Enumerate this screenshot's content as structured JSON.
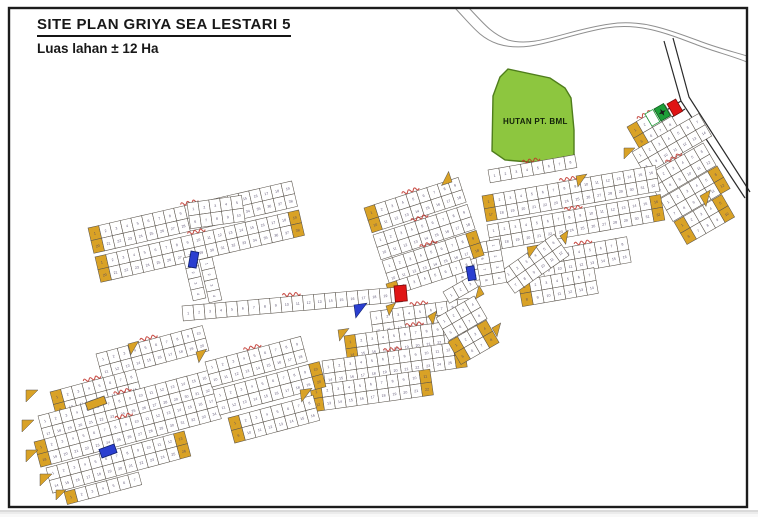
{
  "title": {
    "text": "SITE PLAN GRIYA SEA LESTARI 5",
    "subtitle": "Luas lahan  ± 12 Ha"
  },
  "forest": {
    "label": "HUTAN PT. BML",
    "fill": "#8DC63F",
    "stroke": "#4f7d1c",
    "points": "508,69 550,78 565,88 571,98 574,130 574,160 540,163 505,160 492,151 493,96 500,77"
  },
  "colors": {
    "lot_fill": "#ffffff",
    "lot_stroke": "#5a544c",
    "lot_yellow": "#D9A226",
    "label_red": "#c03028",
    "marker_blue": "#2b3fd0",
    "marker_red": "#e01414",
    "flag_green": "#1e9e38",
    "road_gray": "#8f8f8f",
    "road_dark": "#2a2a2a",
    "frame": "#1c1c1c",
    "number": "#4d4466"
  },
  "block_label_style": {
    "color": "#c03028",
    "legible": false,
    "appearance": "small red handwritten block names, illegible at source resolution"
  },
  "map": {
    "frame": {
      "x": 9,
      "y": 8,
      "w": 738,
      "h": 499
    },
    "roads": {
      "gray": [
        "M455,8 C472,26 480,38 498,44 C530,54 560,36 606,28 C640,22 668,34 700,46 C716,52 732,56 747,62",
        "M469,8 C484,24 492,34 508,40 C536,48 566,30 610,24 C642,19 670,30 702,42 C718,48 734,52 747,56"
      ],
      "dark": [
        "M664,41 L681,101 L745,198",
        "M673,38 L689,97 L750,192",
        "M681,101 L654,118",
        "M685,109 L659,125"
      ]
    },
    "strips": [
      {
        "x": 627,
        "y": 127,
        "a": -30,
        "n": 4,
        "r": 2,
        "ys": true,
        "lbl": true
      },
      {
        "x": 632,
        "y": 152,
        "a": -30,
        "n": 7,
        "r": 2
      },
      {
        "x": 646,
        "y": 176,
        "a": -30,
        "n": 6,
        "r": 2,
        "lbl": true
      },
      {
        "x": 660,
        "y": 199,
        "a": -30,
        "n": 6,
        "r": 2,
        "ye": true
      },
      {
        "x": 674,
        "y": 222,
        "a": -30,
        "n": 5,
        "r": 2,
        "ys": true,
        "ye": true
      },
      {
        "x": 488,
        "y": 170,
        "a": -10,
        "n": 8,
        "r": 1,
        "lbl": true
      },
      {
        "x": 482,
        "y": 196,
        "a": -10,
        "n": 16,
        "r": 2,
        "ys": true,
        "lbl": true
      },
      {
        "x": 487,
        "y": 225,
        "a": -10,
        "n": 16,
        "r": 2,
        "lbl": true,
        "ye": true
      },
      {
        "x": 540,
        "y": 252,
        "a": -10,
        "n": 8,
        "r": 2,
        "lbl": true
      },
      {
        "x": 518,
        "y": 281,
        "a": -10,
        "n": 7,
        "r": 2,
        "ys": true
      },
      {
        "x": 500,
        "y": 272,
        "a": -35,
        "n": 6,
        "r": 2
      },
      {
        "x": 475,
        "y": 236,
        "a": 80,
        "n": 4,
        "r": 2
      },
      {
        "x": 499,
        "y": 239,
        "a": 80,
        "n": 4,
        "r": 2
      },
      {
        "x": 364,
        "y": 208,
        "a": -18,
        "n": 9,
        "r": 2,
        "ys": true,
        "lbl": true
      },
      {
        "x": 373,
        "y": 235,
        "a": -18,
        "n": 9,
        "r": 2,
        "lbl": true
      },
      {
        "x": 382,
        "y": 261,
        "a": -18,
        "n": 9,
        "r": 2,
        "ye": true,
        "lbl": true
      },
      {
        "x": 386,
        "y": 284,
        "a": -18,
        "n": 8,
        "r": 1,
        "ys": true
      },
      {
        "x": 88,
        "y": 228,
        "a": -13,
        "n": 19,
        "r": 2,
        "ys": true,
        "lbl": true
      },
      {
        "x": 95,
        "y": 257,
        "a": -13,
        "n": 19,
        "r": 2,
        "ys": true,
        "ye": true,
        "lbl": true
      },
      {
        "x": 187,
        "y": 203,
        "a": -8,
        "n": 5,
        "r": 2
      },
      {
        "x": 196,
        "y": 255,
        "a": 77,
        "n": 4,
        "r": 1
      },
      {
        "x": 212,
        "y": 257,
        "a": 77,
        "n": 4,
        "r": 1
      },
      {
        "x": 182,
        "y": 306,
        "a": -5,
        "n": 20,
        "r": 1,
        "h": 15,
        "lbl": true
      },
      {
        "x": 370,
        "y": 312,
        "a": -8,
        "n": 9,
        "r": 2,
        "lbl": true
      },
      {
        "x": 344,
        "y": 336,
        "a": -8,
        "n": 13,
        "r": 2,
        "ys": true,
        "lbl": true
      },
      {
        "x": 322,
        "y": 361,
        "a": -8,
        "n": 13,
        "r": 2,
        "ye": true,
        "lbl": true
      },
      {
        "x": 310,
        "y": 386,
        "a": -8,
        "n": 11,
        "r": 2,
        "ys": true,
        "ye": true
      },
      {
        "x": 443,
        "y": 292,
        "a": -30,
        "n": 3,
        "r": 1
      },
      {
        "x": 436,
        "y": 318,
        "a": -30,
        "n": 4,
        "r": 2
      },
      {
        "x": 448,
        "y": 342,
        "a": -30,
        "n": 4,
        "r": 2,
        "ys": true,
        "ye": true
      },
      {
        "x": 96,
        "y": 354,
        "a": -15,
        "n": 10,
        "r": 2,
        "lbl": true
      },
      {
        "x": 50,
        "y": 392,
        "a": -15,
        "n": 8,
        "r": 2,
        "ys": true,
        "lbl": true
      },
      {
        "x": 38,
        "y": 416,
        "a": -15,
        "n": 16,
        "r": 2,
        "lbl": true
      },
      {
        "x": 34,
        "y": 442,
        "a": -15,
        "n": 17,
        "r": 2,
        "ys": true,
        "lbl": true
      },
      {
        "x": 46,
        "y": 468,
        "a": -15,
        "n": 13,
        "r": 2,
        "ye": true
      },
      {
        "x": 64,
        "y": 492,
        "a": -15,
        "n": 7,
        "r": 1,
        "ys": true
      },
      {
        "x": 205,
        "y": 362,
        "a": -15,
        "n": 9,
        "r": 2,
        "lbl": true
      },
      {
        "x": 213,
        "y": 390,
        "a": -15,
        "n": 10,
        "r": 2,
        "ye": true
      },
      {
        "x": 228,
        "y": 418,
        "a": -15,
        "n": 8,
        "r": 2,
        "ys": true
      }
    ],
    "wedges": [
      {
        "x": 624,
        "y": 148,
        "s": 11,
        "a": 0
      },
      {
        "x": 700,
        "y": 196,
        "s": 12,
        "a": -30
      },
      {
        "x": 527,
        "y": 247,
        "s": 11,
        "a": -10
      },
      {
        "x": 560,
        "y": 236,
        "s": 10,
        "a": -35
      },
      {
        "x": 576,
        "y": 176,
        "s": 11,
        "a": -10
      },
      {
        "x": 452,
        "y": 182,
        "s": 11,
        "a": 162
      },
      {
        "x": 386,
        "y": 306,
        "s": 10,
        "a": -18
      },
      {
        "x": 300,
        "y": 390,
        "s": 12,
        "a": -8
      },
      {
        "x": 338,
        "y": 330,
        "s": 11,
        "a": -8
      },
      {
        "x": 428,
        "y": 316,
        "s": 10,
        "a": -30
      },
      {
        "x": 484,
        "y": 294,
        "s": 10,
        "a": 150
      },
      {
        "x": 492,
        "y": 328,
        "s": 10,
        "a": -30
      },
      {
        "x": 26,
        "y": 390,
        "s": 12,
        "a": 0
      },
      {
        "x": 22,
        "y": 420,
        "s": 12,
        "a": 0
      },
      {
        "x": 26,
        "y": 450,
        "s": 12,
        "a": 0
      },
      {
        "x": 40,
        "y": 474,
        "s": 12,
        "a": 0
      },
      {
        "x": 56,
        "y": 490,
        "s": 10,
        "a": 0
      },
      {
        "x": 128,
        "y": 344,
        "s": 11,
        "a": -15
      },
      {
        "x": 196,
        "y": 352,
        "s": 11,
        "a": -15
      }
    ],
    "markers": [
      {
        "type": "flag-white",
        "x": 645,
        "y": 114,
        "w": 9,
        "h": 14,
        "a": -30
      },
      {
        "type": "flag-green-star",
        "x": 654,
        "y": 109,
        "w": 11,
        "h": 14,
        "a": -30
      },
      {
        "type": "flag-red",
        "x": 667,
        "y": 104,
        "w": 10,
        "h": 14,
        "a": -30
      },
      {
        "type": "lot-blue",
        "x": 191,
        "y": 251,
        "w": 8,
        "h": 16,
        "a": 10
      },
      {
        "type": "lot-blue",
        "x": 466,
        "y": 267,
        "w": 8,
        "h": 14,
        "a": -10
      },
      {
        "type": "lot-blue",
        "x": 114,
        "y": 444,
        "w": 9,
        "h": 16,
        "a": 70
      },
      {
        "type": "tri-blue",
        "x": 354,
        "y": 305,
        "s": 13,
        "a": -8
      },
      {
        "type": "lot-red",
        "x": 394,
        "y": 286,
        "w": 12,
        "h": 16,
        "a": -5
      },
      {
        "type": "lot-yellow",
        "x": 104,
        "y": 396,
        "w": 8,
        "h": 20,
        "a": 70
      }
    ]
  }
}
